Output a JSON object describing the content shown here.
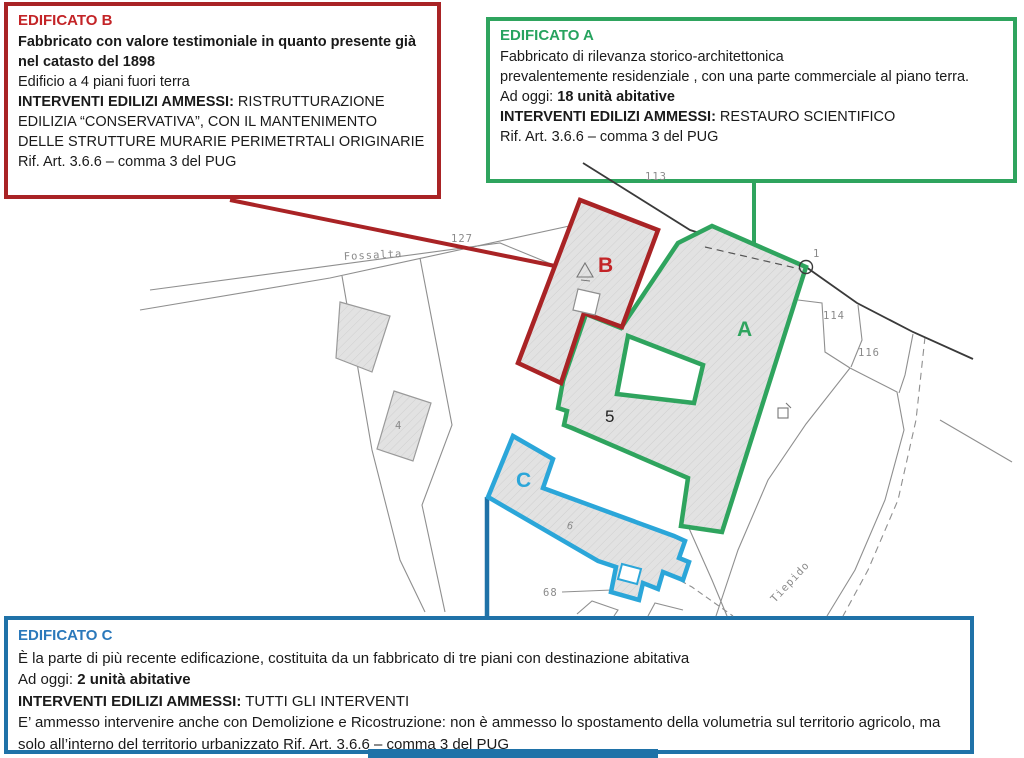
{
  "colors": {
    "red": "#a92325",
    "red_title": "#c32427",
    "green": "#2fa45e",
    "green_title": "#27a35f",
    "blue": "#1f72a8",
    "blue_title": "#2b79bb",
    "c_outline": "#2ba6d9",
    "building_fill": "#e2e2e2",
    "parcel_line": "#8f8f8f",
    "road_line": "#3a3a3a"
  },
  "box_b": {
    "title": "EDIFICATO B",
    "bold_desc": "Fabbricato con valore testimoniale in quanto presente già nel catasto del 1898",
    "line2": "Edificio a 4 piani fuori terra",
    "interventi_label": "INTERVENTI EDILIZI AMMESSI:",
    "interventi_text": "  RISTRUTTURAZIONE EDILIZIA “CONSERVATIVA”, CON IL MANTENIMENTO DELLE STRUTTURE MURARIE PERIMETRTALI ORIGINARIE",
    "rif": "Rif. Art. 3.6.6 – comma 3 del PUG"
  },
  "box_a": {
    "title": "EDIFICATO A",
    "desc_line1": "Fabbricato  di rilevanza storico-architettonica",
    "desc_line2": "prevalentemente residenziale , con una parte commerciale al piano terra.",
    "adoggi_label": "Ad oggi: ",
    "units": "18 unità abitative",
    "interventi_label": "INTERVENTI EDILIZI AMMESSI:",
    "interventi_text": " RESTAURO SCIENTIFICO",
    "rif": "Rif. Art. 3.6.6 – comma 3 del PUG"
  },
  "box_c": {
    "title": "EDIFICATO C",
    "desc": "È la parte di più recente edificazione, costituita da un fabbricato di tre piani con destinazione  abitativa",
    "adoggi_label": "Ad oggi: ",
    "units": "2 unità abitative",
    "interventi_label": "INTERVENTI EDILIZI AMMESSI:",
    "interventi_text": " TUTTI GLI INTERVENTI",
    "demolizione": "E’ ammesso intervenire anche con Demolizione e Ricostruzione: non è ammesso lo spostamento  della volumetria sul territorio agricolo, ma solo all’interno del territorio urbanizzato Rif. Art. 3.6.6 – comma 3 del PUG"
  },
  "map": {
    "building_letters": {
      "a": "A",
      "b": "B",
      "c": "C"
    },
    "labels": {
      "fossalta": "Fossalta",
      "n127": "127",
      "n113": "113",
      "n114": "114",
      "n116": "116",
      "n1": "1",
      "n5": "5",
      "n4": "4",
      "n6": "6",
      "n68": "68",
      "tiepido": "Tiepido"
    }
  }
}
